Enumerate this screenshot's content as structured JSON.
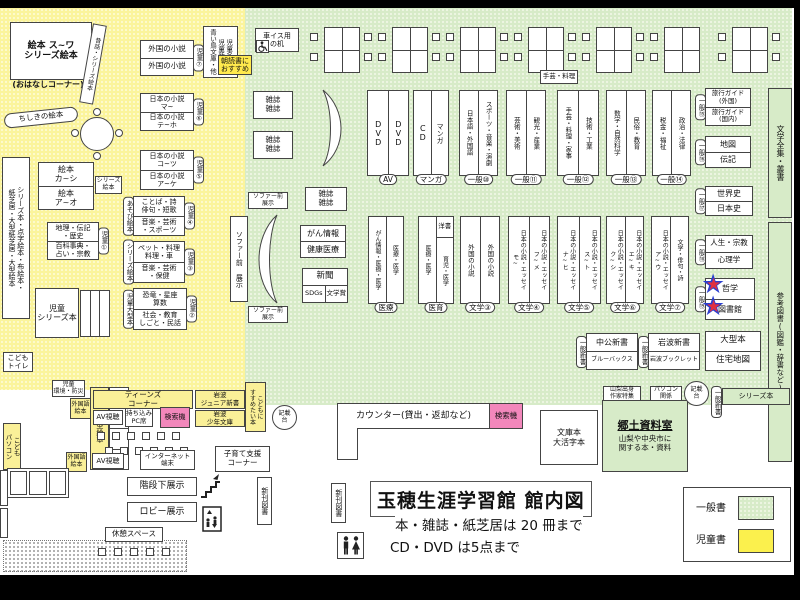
{
  "window": {
    "title_main": "玉穂生涯学習館 館内図",
    "note1": "本・雑誌・紙芝居は 20 冊まで",
    "note2": "CD・DVD は5点まで"
  },
  "legend": {
    "general": "一般書",
    "children": "児童書"
  },
  "colors": {
    "general_zone": "#d7ebc8",
    "children_zone": "#fbf49c",
    "search_machine": "#f287bb",
    "highlight": "#ffe94d",
    "star_red": "#e03040",
    "star_blue": "#2b3fd0"
  },
  "children_zone": {
    "ehon_suwa": "絵本 ス~ワ\nシリーズ絵本",
    "ohanashi": "(おはなしコーナー)",
    "mukashibanashi": "昔話・シリーズ絵本",
    "chishiki": "ちしきの絵本",
    "kamishibai_tall": "シリーズ本・点字絵本・布絵本・\n紙芝居・大型紙芝居・大型絵本",
    "ehon_kashi": "絵本\nカ~シ",
    "ehon_ao": "絵本\nア~オ",
    "series_ehon": "シリーズ\n絵本",
    "jido1_r1": "地理・伝記\n・歴史",
    "jido1_r2": "百科事典・\n占い・宗教",
    "jido1_tag": "児童①",
    "jido7_r1": "外国の小説",
    "jido7_r2": "外国の小説",
    "jido7_tag": "児童⑦",
    "jido6_r1": "日本の小説\nマ~",
    "jido6_r2": "日本の小説\nテ~ホ",
    "jido6_tag": "児童⑥",
    "jido5_r1": "日本の小説\nコ~ツ",
    "jido5_r2": "日本の小説\nア~ケ",
    "jido5_tag": "児童⑤",
    "jido4_r1": "ことば・詩\n俳句・短歌",
    "jido4_r2": "音楽・芸術\n・スポーツ",
    "jido4_tag": "児童④",
    "jido4_side": "あそび絵本",
    "jido3_r1": "ペット・料理\n料理・車",
    "jido3_r2": "音楽・芸術\n・保健",
    "jido3_tag": "児童③",
    "jido3_side": "シリーズ絵本",
    "jido2_r1": "恐竜・星座\n算数",
    "jido2_r2": "社会・教育\nしごと・民話",
    "jido2_tag": "児童②",
    "jido2_side": "児童大型本",
    "jido_series": "児童\nシリーズ本",
    "jido_shinsho": "児童名作\n児童新書\n青い鳥文庫・他",
    "asadoku": "朝読書に\nおすすめ",
    "kodomo_toilet": "こども\nトイレ",
    "jido_kankyo": "児童\n環境・防災",
    "ogata_ehon": "大型絵本",
    "kodomo_pc": "こども\nパソコン",
    "teens": "ティーンズ\nコーナー",
    "iwanami_junior": "岩波\nジュニア新書",
    "iwanami_shonen": "岩波\n少年文庫",
    "gaikokugo_ehon": "外国語\n絵本",
    "av_shicho": "AV視聴",
    "pc_seki": "持ち込み\nPC席",
    "kensakuki": "検索機",
    "susumetai": "こどもに\nすすめたい本",
    "internet": "インターネット\n端末",
    "kosodate": "子育て支援\nコーナー"
  },
  "general_zone": {
    "kurumaisu": "車イス用\nの机",
    "zasshi": "雑誌\n雑誌",
    "teshigei_ryori": "手芸・料理",
    "sofa_mae": "ソファー前\n展示",
    "sofa_mae_v": "ソファー前 展示",
    "gan_joho": "がん情報",
    "kenko_iryo": "健康医療",
    "shinbun": "新聞",
    "sdgs": "SDGs",
    "bungakusho": "文学賞",
    "shelf_av_l": "DVD",
    "shelf_av_r": "DVD",
    "shelf_av_tag": "AV",
    "shelf_cd_l": "CD",
    "shelf_cd_r": "マンガ",
    "shelf_cd_tag": "マンガ",
    "g10_l": "日本語・外国語",
    "g10_r": "スポーツ・音楽・演劇",
    "g10_tag": "一般⑩",
    "g11_l": "芸術・美術",
    "g11_r": "観光・産業",
    "g11_tag": "一般⑪",
    "g12_l": "手芸・料理・家事",
    "g12_r": "技術・工業",
    "g12_tag": "一般⑫",
    "g13_l": "数学・自然科学",
    "g13_r": "民俗・教育",
    "g13_tag": "一般⑬",
    "g14_l": "税金・福祉",
    "g14_r": "政治・法律",
    "g14_tag": "一般⑭",
    "iryo_l": "がん情報・医療・医学",
    "iryo_r": "医療・医学",
    "iryo_tag": "医療",
    "iiku_l": "医療・医学",
    "iiku_rtop": "洋書",
    "iiku_rbot": "育児・医学",
    "iiku_tag": "医育",
    "b3_l": "外国の小説",
    "b3_r": "外国の小説",
    "b3_tag": "文学③",
    "b4_l": "日本の小説・エッセイ\nモ~",
    "b4_r": "日本の小説・エッセイ\nフ~メ",
    "b4_tag": "文学④",
    "b5_l": "日本の小説・エッセイ\nナ~ヒ",
    "b5_r": "日本の小説・エッセイ\nス~ト",
    "b5_tag": "文学⑤",
    "b6_l": "日本の小説・エッセイ\nク~シ",
    "b6_r": "日本の小説・エッセイ\nエ~キ",
    "b6_tag": "文学⑥",
    "b7_l": "日本の小説・エッセイ\nア~ウ",
    "b7_r": "文学・俳句・詩",
    "b7_tag": "文学⑦",
    "g15_r1": "旅行ガイド\n(外国)",
    "g15_r2": "旅行ガイド\n(国内)",
    "g15_tag": "一般⑮",
    "g16_r1": "地図",
    "g16_r2": "伝記",
    "g16_tag": "一般⑯",
    "g17_r1": "世界史",
    "g17_r2": "日本史",
    "g17_tag": "一般⑰",
    "g18_r1": "人生・宗教",
    "g18_r2": "心理学",
    "g18_tag": "一般⑱",
    "g19_r1": "哲学",
    "g19_r2": "図書館",
    "g19_tag": "一般⑲",
    "bungaku_zenshu": "文学全集・叢書",
    "sanko_tosho": "参考図書(図鑑・辞書など)",
    "chuko": "中公新書",
    "bluebacks": "ブルーバックス",
    "iwanami_shinsho": "岩波新書",
    "iwanami_booklet": "岩波ブックレット",
    "ippan_shinsho": "一般新書",
    "ogata_hon": "大型本",
    "jutaku_chizu": "住宅地図",
    "yamanashi": "山梨出身\n作家特集",
    "pc_kankei": "パソコン\n関係",
    "kisaidai": "記載\n台",
    "series_hon": "シリーズ本",
    "bunko": "文庫本\n大活字本",
    "kyodo_title": "郷土資料室",
    "kyodo_body": "山梨や中央市に\n関する本・資料",
    "counter": "カウンター(貸出・返却など)"
  },
  "bottom": {
    "kaidan": "階段下展示",
    "lobby": "ロビー展示",
    "kyukei": "休憩スペース",
    "shinkan": "新刊図書"
  }
}
